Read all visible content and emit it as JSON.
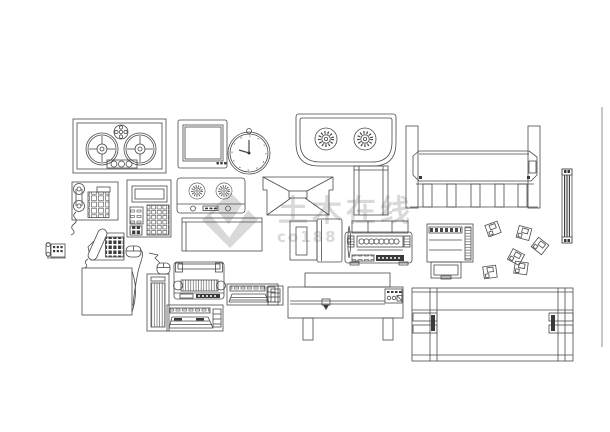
{
  "canvas": {
    "width": 610,
    "height": 432,
    "background": "#ffffff",
    "line_color": "#4a4a4a"
  },
  "watermark": {
    "text": "土木在线",
    "subtext": "co188",
    "color": "#d9d9d9",
    "logo": "co188-diamond-logo"
  },
  "blocks": [
    "reel-to-reel-recorder",
    "tv-monitor",
    "wall-clock",
    "gas-stove",
    "ac-plotter-unit",
    "wall-phone",
    "calculator-console",
    "knob-deck",
    "storage-box",
    "ceiling-projector",
    "roll-screen",
    "crt-monitor-side",
    "typewriter-fax",
    "copier-printer",
    "floppy-disks",
    "fluorescent-tube",
    "sheet-border",
    "mini-phone",
    "desk-phone",
    "mouse",
    "monitor-rear-box",
    "mouse-2",
    "pc-tower",
    "dot-matrix-printer",
    "keyboard",
    "keyboard-2",
    "plotter-front",
    "drive-unit",
    "plotter-top"
  ]
}
